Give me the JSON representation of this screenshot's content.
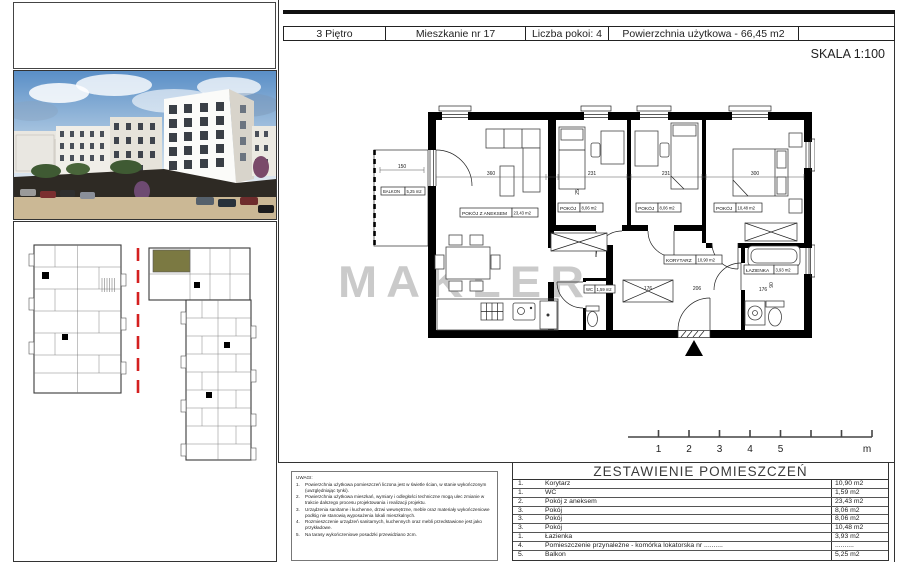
{
  "header": {
    "cells": [
      "3 Piętro",
      "Mieszkanie nr 17",
      "Liczba pokoi: 4",
      "Powierzchnia użytkowa - 66,45 m2"
    ],
    "scale_label": "SKALA 1:100"
  },
  "watermark": "MAKLER",
  "floor_plan": {
    "labels": [
      {
        "name": "BALKON",
        "area": "5,25 m2"
      },
      {
        "name": "POKÓJ Z ANEKSEM",
        "area": "23,43 m2"
      },
      {
        "name": "POKÓJ",
        "area": "8,06 m2"
      },
      {
        "name": "POKÓJ",
        "area": "8,06 m2"
      },
      {
        "name": "POKÓJ",
        "area": "10,48 m2"
      },
      {
        "name": "KORYTARZ",
        "area": "10,90 m2"
      },
      {
        "name": "ŁAZIENKA",
        "area": "3,93 m2"
      },
      {
        "name": "WC",
        "area": "1,59 m2"
      }
    ],
    "dims": [
      "150",
      "360",
      "231",
      "231",
      "300",
      "25",
      "176",
      "206",
      "176",
      "90"
    ]
  },
  "scale_bar": {
    "labels": [
      "1",
      "2",
      "3",
      "4",
      "5"
    ],
    "unit": "m"
  },
  "notes": {
    "title": "UWAGI:",
    "items": [
      {
        "no": "1.",
        "text": "Powierzchnia użytkowa pomieszczeń liczona jest w świetle ścian, w stanie wykończonym (uwzględniając tynki)."
      },
      {
        "no": "2.",
        "text": "Powierzchnia użytkowa mieszkań, wymiary i odległości techniczne mogą ulec zmianie w trakcie dalszego procesu projektowania i realizacji projektu."
      },
      {
        "no": "3.",
        "text": "Urządzenia sanitarne i kuchenne, drzwi wewnętrzne, meble oraz materiały wykończeniowe podłóg nie stanowią wyposażenia lokali mieszkalnych."
      },
      {
        "no": "4.",
        "text": "Rozmieszczenie urządzeń sanitarnych, kuchennych oraz mebli przedstawione jest jako przykładowe."
      },
      {
        "no": "5.",
        "text": "Na tarasy wykończeniowe posadzki przewidziano 2cm."
      }
    ]
  },
  "rooms_table": {
    "title": "ZESTAWIENIE POMIESZCZEŃ",
    "rows": [
      {
        "no": "1.",
        "name": "Korytarz",
        "area": "10,90 m2"
      },
      {
        "no": "1.",
        "name": "WC",
        "area": "1,59 m2"
      },
      {
        "no": "2.",
        "name": "Pokój z aneksem",
        "area": "23,43 m2"
      },
      {
        "no": "3.",
        "name": "Pokój",
        "area": "8,06 m2"
      },
      {
        "no": "3.",
        "name": "Pokój",
        "area": "8,06 m2"
      },
      {
        "no": "3.",
        "name": "Pokój",
        "area": "10,48 m2"
      },
      {
        "no": "1.",
        "name": "Łazienka",
        "area": "3,93 m2"
      },
      {
        "no": "4.",
        "name": "Pomieszczenie przynależne - komórka lokatorska nr ..........",
        "area": ".........."
      },
      {
        "no": "5.",
        "name": "Balkon",
        "area": "5,25 m2"
      }
    ]
  },
  "colors": {
    "highlight_unit": "#7b7942",
    "key_line": "#d42020",
    "watermark": "#9f9f9f"
  }
}
